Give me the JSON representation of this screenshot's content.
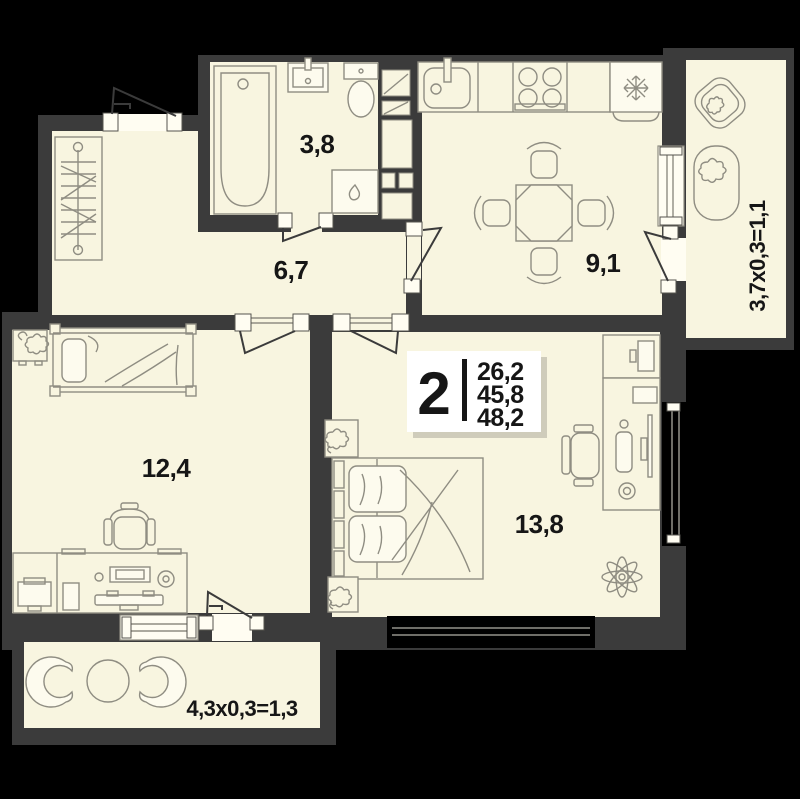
{
  "plan": {
    "type": "apartment-floor-plan",
    "colors": {
      "background": "#000000",
      "walls": "#3b3b3b",
      "floor": "#f8f5e0",
      "fixtures": "#8f8d82",
      "text": "#161616",
      "highlight": "#ffffff"
    },
    "rooms": [
      {
        "id": "bathroom",
        "area_label": "3,8"
      },
      {
        "id": "hallway",
        "area_label": "6,7"
      },
      {
        "id": "kitchen",
        "area_label": "9,1"
      },
      {
        "id": "bedroom-left",
        "area_label": "12,4"
      },
      {
        "id": "bedroom-right",
        "area_label": "13,8"
      }
    ],
    "balconies": [
      {
        "id": "balcony-right",
        "dimension_label": "3,7x0,3=1,1"
      },
      {
        "id": "balcony-bottom",
        "dimension_label": "4,3x0,3=1,3"
      }
    ],
    "summary": {
      "rooms_count": "2",
      "area_living": "26,2",
      "area_apartment": "45,8",
      "area_total": "48,2"
    }
  }
}
